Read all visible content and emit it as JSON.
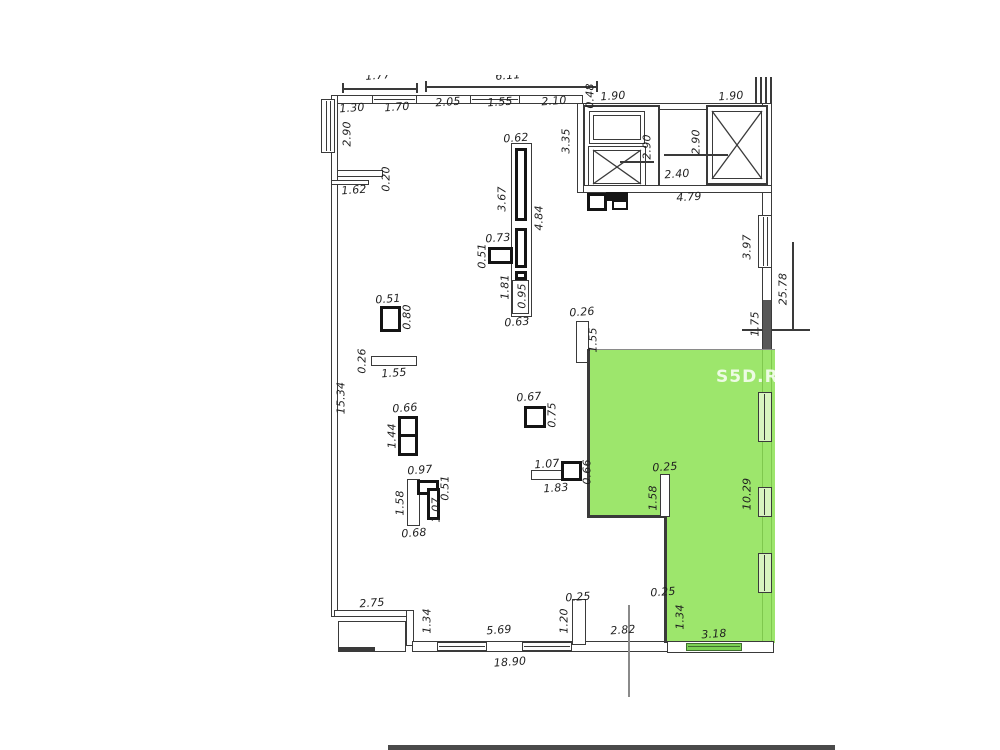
{
  "title": "apartment-floor-plan",
  "watermark": "S5D.RU",
  "colors": {
    "highlight": "#8ce252",
    "line": "#3a3a3a",
    "wall_dark": "#585858"
  },
  "dims": {
    "clip_left": "1.77",
    "clip_right": "6.11",
    "top": {
      "a": "1.30",
      "b": "1.70",
      "c": "2.05",
      "d": "1.55",
      "e": "2.10",
      "f": "0.48",
      "g": "1.90",
      "h": "1.90"
    },
    "leftwall": {
      "a": "2.90",
      "b": "0.20",
      "c": "1.62",
      "d": "15.34"
    },
    "elevator": {
      "a": "3.35",
      "b": "2.90",
      "c": "2.90",
      "d": "2.40",
      "e": "4.79"
    },
    "partition": {
      "a": "0.62",
      "b": "3.67",
      "c": "4.84",
      "d": "0.73",
      "e": "0.51",
      "f": "1.81",
      "g": "0.95",
      "h": "0.63"
    },
    "rightwall": {
      "a": "3.97",
      "b": "25.78",
      "c": "1.75",
      "d": "10.29"
    },
    "col1": {
      "a": "0.51",
      "b": "0.80"
    },
    "shelf1": {
      "a": "0.26",
      "b": "1.55"
    },
    "col2": {
      "a": "0.66",
      "b": "1.44"
    },
    "col3": {
      "a": "0.97",
      "b": "1.58",
      "c": "0.51",
      "d": "1.07",
      "e": "0.68"
    },
    "col4": {
      "a": "0.67",
      "b": "0.75"
    },
    "col5": {
      "a": "1.07",
      "b": "1.83",
      "c": "0.66"
    },
    "slot1": {
      "a": "0.26",
      "b": "1.55"
    },
    "slot2": {
      "a": "0.25",
      "b": "1.58"
    },
    "bottom": {
      "a": "2.75",
      "b": "1.34",
      "c": "5.69",
      "d": "1.20",
      "e": "0.25",
      "f": "2.82",
      "g": "18.90"
    },
    "greenroom": {
      "a": "0.25",
      "b": "1.34",
      "c": "3.18"
    }
  }
}
